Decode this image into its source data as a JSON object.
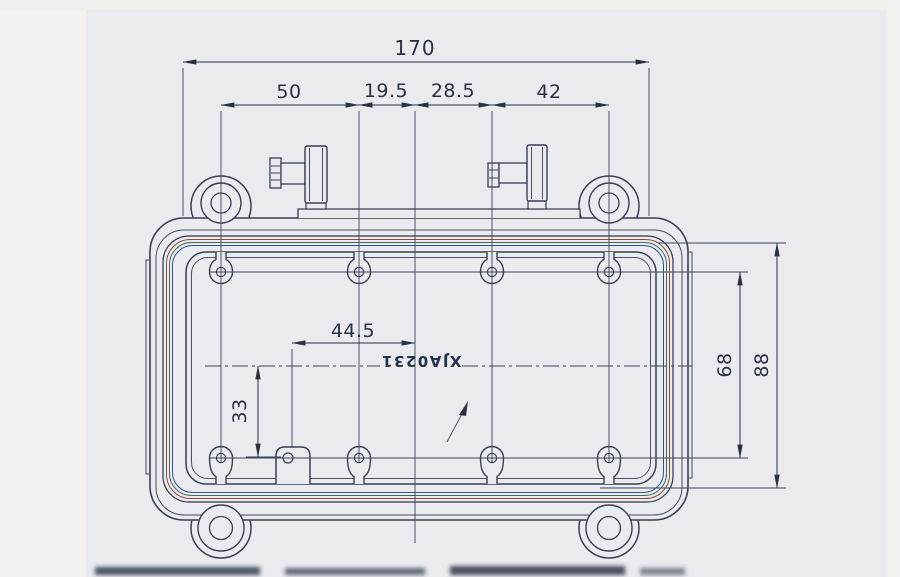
{
  "drawing": {
    "part_label": "XJA0231",
    "dims": {
      "overall_width": "170",
      "seg_left": "50",
      "seg_mid_left": "19.5",
      "seg_mid_right": "28.5",
      "seg_right": "42",
      "boss_to_centerline": "44.5",
      "centerline_to_boss_row": "33",
      "boss_row_spacing": "68",
      "body_height": "88"
    },
    "colors": {
      "paper": "#e9ebef",
      "paper_left_band": "#f4f2ee",
      "line": "#39414f",
      "dim_ink": "#2a3240",
      "seal_red": "#8c4a3c",
      "seal_green": "#3f6b58",
      "seal_blue": "#35508e"
    }
  }
}
